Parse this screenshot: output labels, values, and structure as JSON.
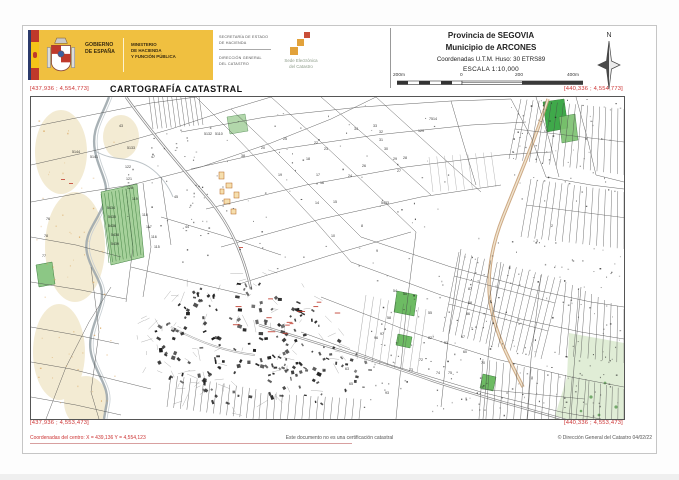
{
  "header": {
    "gobierno_l1": "GOBIERNO",
    "gobierno_l2": "DE ESPAÑA",
    "ministerio_l1": "MINISTERIO",
    "ministerio_l2": "DE HACIENDA",
    "ministerio_l3": "Y FUNCIÓN PÚBLICA",
    "secretaria_l1": "SECRETARÍA DE ESTADO",
    "secretaria_l2": "DE HACIENDA",
    "direccion_l1": "DIRECCIÓN GENERAL",
    "direccion_l2": "DEL CATASTRO",
    "sede_l1": "Sede Electrónica",
    "sede_l2": "del Catastro",
    "provincia": "Provincia de SEGOVIA",
    "municipio": "Municipio de ARCONES",
    "coords_utm": "Coordenadas U.T.M. Huso: 30 ETRS89",
    "escala": "ESCALA 1:10,000",
    "scale_labels": [
      "200m",
      "0",
      "200",
      "400m"
    ],
    "north": "N"
  },
  "title": "CARTOGRAFÍA CATASTRAL",
  "map": {
    "corner_tl": "[437,936 ; 4,554,773]",
    "corner_tr": "[440,336 ; 4,554,773]",
    "corner_bl": "[437,936 ; 4,553,473]",
    "corner_br": "[440,336 ; 4,553,473]",
    "parcel_labels": [
      {
        "t": "5434",
        "x": 76,
        "y": 112
      },
      {
        "t": "5435",
        "x": 77,
        "y": 121
      },
      {
        "t": "5436",
        "x": 77,
        "y": 130
      },
      {
        "t": "5438",
        "x": 80,
        "y": 139
      },
      {
        "t": "5439",
        "x": 80,
        "y": 148
      },
      {
        "t": "122",
        "x": 94,
        "y": 71
      },
      {
        "t": "121",
        "x": 95,
        "y": 83
      },
      {
        "t": "128",
        "x": 96,
        "y": 92
      },
      {
        "t": "119",
        "x": 101,
        "y": 103
      },
      {
        "t": "118",
        "x": 111,
        "y": 119
      },
      {
        "t": "117",
        "x": 115,
        "y": 131
      },
      {
        "t": "116",
        "x": 120,
        "y": 141
      },
      {
        "t": "115",
        "x": 123,
        "y": 151
      },
      {
        "t": "5144",
        "x": 41,
        "y": 56
      },
      {
        "t": "5141",
        "x": 59,
        "y": 61
      },
      {
        "t": "76",
        "x": 15,
        "y": 123
      },
      {
        "t": "78",
        "x": 13,
        "y": 140
      },
      {
        "t": "77",
        "x": 11,
        "y": 160
      },
      {
        "t": "43",
        "x": 88,
        "y": 30
      },
      {
        "t": "47",
        "x": 120,
        "y": 61
      },
      {
        "t": "45",
        "x": 143,
        "y": 101
      },
      {
        "t": "44",
        "x": 154,
        "y": 131
      },
      {
        "t": "5133",
        "x": 96,
        "y": 52
      },
      {
        "t": "5132",
        "x": 173,
        "y": 38
      },
      {
        "t": "5110",
        "x": 184,
        "y": 38
      },
      {
        "t": "25",
        "x": 252,
        "y": 43
      },
      {
        "t": "22",
        "x": 283,
        "y": 47
      },
      {
        "t": "23",
        "x": 293,
        "y": 53
      },
      {
        "t": "20",
        "x": 230,
        "y": 52
      },
      {
        "t": "18",
        "x": 275,
        "y": 63
      },
      {
        "t": "19",
        "x": 247,
        "y": 79
      },
      {
        "t": "17",
        "x": 285,
        "y": 79
      },
      {
        "t": "16",
        "x": 289,
        "y": 87
      },
      {
        "t": "24",
        "x": 317,
        "y": 80
      },
      {
        "t": "14",
        "x": 284,
        "y": 107
      },
      {
        "t": "15",
        "x": 302,
        "y": 106
      },
      {
        "t": "34",
        "x": 323,
        "y": 33
      },
      {
        "t": "33",
        "x": 342,
        "y": 30
      },
      {
        "t": "32",
        "x": 348,
        "y": 36
      },
      {
        "t": "31",
        "x": 348,
        "y": 44
      },
      {
        "t": "30",
        "x": 353,
        "y": 53
      },
      {
        "t": "29",
        "x": 362,
        "y": 63
      },
      {
        "t": "26",
        "x": 331,
        "y": 70
      },
      {
        "t": "28",
        "x": 372,
        "y": 62
      },
      {
        "t": "27",
        "x": 366,
        "y": 75
      },
      {
        "t": "7514",
        "x": 398,
        "y": 23
      },
      {
        "t": "129",
        "x": 387,
        "y": 35
      },
      {
        "t": "5433",
        "x": 350,
        "y": 107
      },
      {
        "t": "8",
        "x": 330,
        "y": 130
      },
      {
        "t": "9",
        "x": 345,
        "y": 155
      },
      {
        "t": "10",
        "x": 300,
        "y": 140
      },
      {
        "t": "2",
        "x": 520,
        "y": 130
      },
      {
        "t": "3",
        "x": 505,
        "y": 145
      },
      {
        "t": "38",
        "x": 210,
        "y": 60
      },
      {
        "t": "87",
        "x": 437,
        "y": 193
      },
      {
        "t": "88",
        "x": 437,
        "y": 207
      },
      {
        "t": "86",
        "x": 435,
        "y": 218
      },
      {
        "t": "82",
        "x": 397,
        "y": 242
      },
      {
        "t": "51",
        "x": 413,
        "y": 247
      },
      {
        "t": "67",
        "x": 430,
        "y": 241
      },
      {
        "t": "60",
        "x": 432,
        "y": 256
      },
      {
        "t": "70",
        "x": 450,
        "y": 267
      },
      {
        "t": "72",
        "x": 388,
        "y": 264
      },
      {
        "t": "73",
        "x": 378,
        "y": 274
      },
      {
        "t": "74",
        "x": 405,
        "y": 277
      },
      {
        "t": "75",
        "x": 417,
        "y": 277
      },
      {
        "t": "93",
        "x": 354,
        "y": 297
      },
      {
        "t": "58",
        "x": 356,
        "y": 222
      },
      {
        "t": "97",
        "x": 349,
        "y": 238
      },
      {
        "t": "96",
        "x": 343,
        "y": 242
      },
      {
        "t": "54",
        "x": 362,
        "y": 195
      },
      {
        "t": "50",
        "x": 372,
        "y": 198
      },
      {
        "t": "55",
        "x": 397,
        "y": 217
      },
      {
        "t": "63",
        "x": 314,
        "y": 273
      },
      {
        "t": "65",
        "x": 318,
        "y": 288
      }
    ]
  },
  "footer": {
    "center_coords": "Coordenadas del centro: X = 439,136 Y = 4,554,123",
    "disclaimer": "Este documento no es una certificación catastral",
    "copyright": "© Dirección General del Catastro 04/02/22"
  },
  "colors": {
    "accent_red": "#cc3333",
    "header_yellow": "#f0c040",
    "parcel_green": "#6dbb63",
    "road_brown": "#c49a6e"
  }
}
